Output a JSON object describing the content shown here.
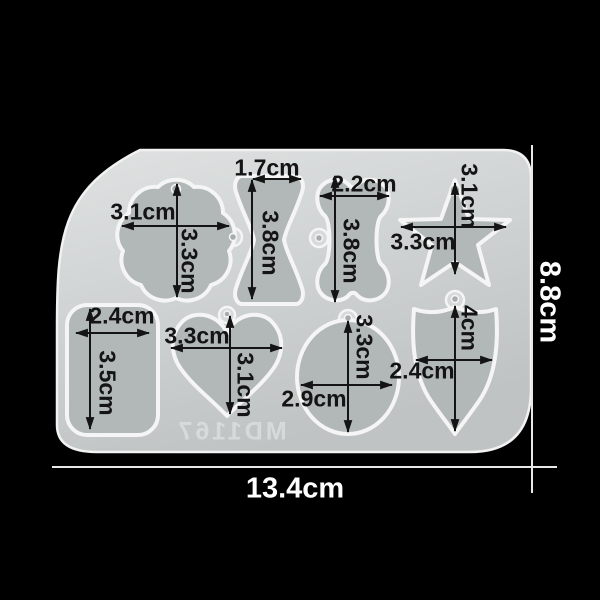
{
  "scene": {
    "background_color": "#000000",
    "mold_code_mirrored": "MD1167",
    "overall_width": "13.4cm",
    "overall_height": "8.8cm"
  },
  "cavities": [
    {
      "name": "cupcake",
      "width": "3.1cm",
      "height": "3.3cm"
    },
    {
      "name": "bowtie",
      "width": "1.7cm",
      "height": "3.8cm"
    },
    {
      "name": "bone",
      "width": "2.2cm",
      "height": "3.8cm"
    },
    {
      "name": "star",
      "width": "3.3cm",
      "height": "3.1cm"
    },
    {
      "name": "rectangle",
      "width": "2.4cm",
      "height": "3.5cm"
    },
    {
      "name": "heart",
      "width": "3.3cm",
      "height": "3.1cm"
    },
    {
      "name": "circle",
      "width": "2.9cm",
      "height": "3.3cm"
    },
    {
      "name": "shield",
      "width": "2.4cm",
      "height": "4cm"
    }
  ],
  "colors": {
    "mold_surface": "#ccd0d0",
    "mold_rim": "#f2f2f2",
    "cavity_fill": "#b2b8b8",
    "cavity_rim": "#f5f5f5",
    "annotation_text": "#141414",
    "dimension_line": "#e8e8e8",
    "overall_text": "#ffffff"
  }
}
